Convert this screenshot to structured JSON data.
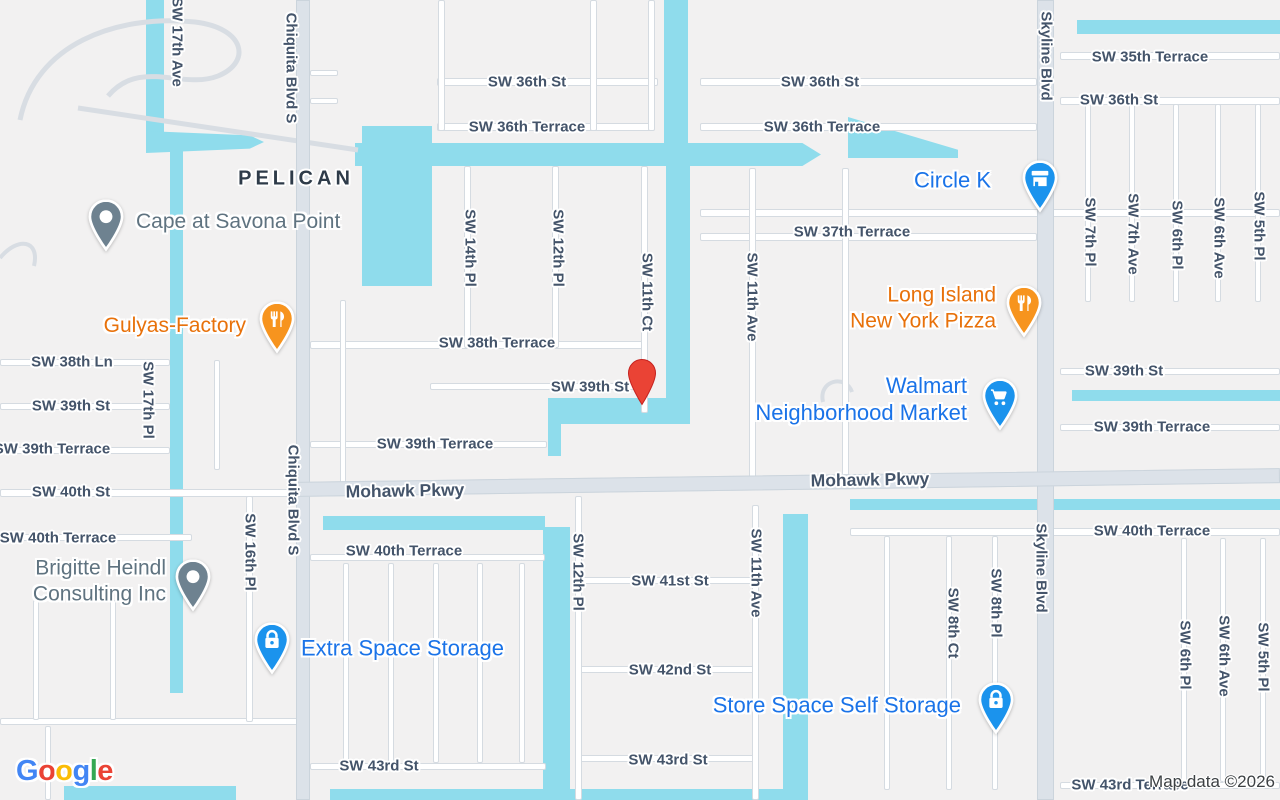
{
  "map": {
    "attribution": "Map data ©2026",
    "area_label": "PELICAN",
    "google_logo": {
      "text": "Google",
      "letters": [
        {
          "ch": "G",
          "color": "#4285F4"
        },
        {
          "ch": "o",
          "color": "#EA4335"
        },
        {
          "ch": "o",
          "color": "#FBBC05"
        },
        {
          "ch": "g",
          "color": "#4285F4"
        },
        {
          "ch": "l",
          "color": "#34A853"
        },
        {
          "ch": "e",
          "color": "#EA4335"
        }
      ]
    },
    "colors": {
      "land": "#F2F1F1",
      "water": "#8FDCEC",
      "road_minor": "#FFFFFF",
      "road_casing": "#D5DBE1",
      "road_major": "#DCE2E9",
      "street_text": "#44546A",
      "area_text": "#2E3B49",
      "poi_blue": "#1A73E8",
      "poi_orange": "#E8710A",
      "poi_gray": "#5F7380",
      "pin_blue": "#1B93ED",
      "pin_orange": "#F7941E",
      "pin_gray": "#6E8290",
      "marker_red": "#EA4335",
      "attribution_text": "#3C4043"
    },
    "marker": {
      "x": 642,
      "y": 404,
      "place_hint": "SW 39th St"
    },
    "street_labels": [
      {
        "text": "SW 36th St",
        "x": 527,
        "y": 82
      },
      {
        "text": "SW 36th Terrace",
        "x": 527,
        "y": 127
      },
      {
        "text": "SW 36th St",
        "x": 820,
        "y": 82
      },
      {
        "text": "SW 36th Terrace",
        "x": 822,
        "y": 127
      },
      {
        "text": "SW 35th Terrace",
        "x": 1150,
        "y": 57
      },
      {
        "text": "SW 36th St",
        "x": 1119,
        "y": 100
      },
      {
        "text": "SW 37th Terrace",
        "x": 852,
        "y": 232
      },
      {
        "text": "SW 38th Terrace",
        "x": 497,
        "y": 343
      },
      {
        "text": "SW 39th St",
        "x": 590,
        "y": 387
      },
      {
        "text": "SW 38th Ln",
        "x": 72,
        "y": 362
      },
      {
        "text": "SW 39th St",
        "x": 71,
        "y": 406
      },
      {
        "text": "SW 39th Terrace",
        "x": 52,
        "y": 449
      },
      {
        "text": "SW 40th St",
        "x": 71,
        "y": 492
      },
      {
        "text": "SW 40th Terrace",
        "x": 58,
        "y": 538
      },
      {
        "text": "SW 39th Terrace",
        "x": 435,
        "y": 444
      },
      {
        "text": "SW 40th Terrace",
        "x": 404,
        "y": 551
      },
      {
        "text": "SW 41st St",
        "x": 670,
        "y": 581
      },
      {
        "text": "SW 42nd St",
        "x": 670,
        "y": 670
      },
      {
        "text": "SW 43rd St",
        "x": 668,
        "y": 760
      },
      {
        "text": "SW 43rd St",
        "x": 379,
        "y": 766
      },
      {
        "text": "SW 39th St",
        "x": 1124,
        "y": 371
      },
      {
        "text": "SW 39th Terrace",
        "x": 1152,
        "y": 427
      },
      {
        "text": "SW 40th Terrace",
        "x": 1152,
        "y": 531
      },
      {
        "text": "SW 43rd Terrace",
        "x": 1130,
        "y": 785
      },
      {
        "text": "Mohawk Pkwy",
        "x": 405,
        "y": 491,
        "major": true,
        "rot": -1
      },
      {
        "text": "Mohawk Pkwy",
        "x": 870,
        "y": 480,
        "major": true,
        "rot": -1
      },
      {
        "text": "PELICAN",
        "x": 296,
        "y": 179,
        "area": true
      },
      {
        "text": "SW 17th Ave",
        "x": 177,
        "y": 42,
        "v": true
      },
      {
        "text": "Chiquita Blvd S",
        "x": 291,
        "y": 68,
        "v": true
      },
      {
        "text": "Chiquita Blvd S",
        "x": 293,
        "y": 500,
        "v": true
      },
      {
        "text": "SW 17th Pl",
        "x": 148,
        "y": 400,
        "v": true
      },
      {
        "text": "SW 16th Pl",
        "x": 250,
        "y": 552,
        "v": true
      },
      {
        "text": "SW 14th Pl",
        "x": 470,
        "y": 248,
        "v": true
      },
      {
        "text": "SW 12th Pl",
        "x": 558,
        "y": 248,
        "v": true
      },
      {
        "text": "SW 11th Ct",
        "x": 647,
        "y": 292,
        "v": true
      },
      {
        "text": "SW 11th Ave",
        "x": 752,
        "y": 297,
        "v": true
      },
      {
        "text": "Skyline Blvd",
        "x": 1046,
        "y": 56,
        "v": true
      },
      {
        "text": "Skyline Blvd",
        "x": 1041,
        "y": 568,
        "v": true
      },
      {
        "text": "SW 7th Pl",
        "x": 1090,
        "y": 232,
        "v": true
      },
      {
        "text": "SW 7th Ave",
        "x": 1133,
        "y": 234,
        "v": true
      },
      {
        "text": "SW 6th Pl",
        "x": 1177,
        "y": 235,
        "v": true
      },
      {
        "text": "SW 6th Ave",
        "x": 1219,
        "y": 238,
        "v": true
      },
      {
        "text": "SW 5th Pl",
        "x": 1259,
        "y": 226,
        "v": true
      },
      {
        "text": "SW 12th Pl",
        "x": 578,
        "y": 572,
        "v": true
      },
      {
        "text": "SW 11th Ave",
        "x": 756,
        "y": 573,
        "v": true
      },
      {
        "text": "SW 8th Ct",
        "x": 953,
        "y": 623,
        "v": true
      },
      {
        "text": "SW 8th Pl",
        "x": 996,
        "y": 603,
        "v": true
      },
      {
        "text": "SW 6th Pl",
        "x": 1185,
        "y": 655,
        "v": true
      },
      {
        "text": "SW 6th Ave",
        "x": 1224,
        "y": 656,
        "v": true
      },
      {
        "text": "SW 5th Pl",
        "x": 1263,
        "y": 657,
        "v": true
      }
    ],
    "pois": [
      {
        "id": "cape-at-savona-point",
        "lines": [
          "Cape at Savona Point"
        ],
        "category": "generic",
        "icon": "dot-icon",
        "tip_x": 106,
        "tip_y": 251,
        "label_side": "right",
        "label_x": 136,
        "label_y": 222,
        "font": 21
      },
      {
        "id": "gulyas-factory",
        "lines": [
          "Gulyas-Factory"
        ],
        "category": "restaurant",
        "icon": "restaurant-icon",
        "tip_x": 277,
        "tip_y": 353,
        "label_side": "left",
        "label_x": 246,
        "label_y": 326,
        "font": 21
      },
      {
        "id": "circle-k",
        "lines": [
          "Circle K"
        ],
        "category": "convenience-store",
        "icon": "store-icon",
        "tip_x": 1040,
        "tip_y": 212,
        "label_side": "left",
        "label_x": 991,
        "label_y": 181,
        "font": 22
      },
      {
        "id": "long-island-new-york-pizza",
        "lines": [
          "Long Island",
          "New York Pizza"
        ],
        "category": "restaurant",
        "icon": "restaurant-icon",
        "tip_x": 1024,
        "tip_y": 337,
        "label_side": "left",
        "label_x": 996,
        "label_y": 308,
        "font": 21
      },
      {
        "id": "walmart-neighborhood-market",
        "lines": [
          "Walmart",
          "Neighborhood Market"
        ],
        "category": "shopping",
        "icon": "cart-icon",
        "tip_x": 1000,
        "tip_y": 430,
        "label_side": "left",
        "label_x": 967,
        "label_y": 400,
        "font": 22
      },
      {
        "id": "extra-space-storage",
        "lines": [
          "Extra Space Storage"
        ],
        "category": "storage",
        "icon": "lock-icon",
        "tip_x": 272,
        "tip_y": 674,
        "label_side": "right",
        "label_x": 301,
        "label_y": 649,
        "font": 22
      },
      {
        "id": "store-space-self-storage",
        "lines": [
          "Store Space Self Storage"
        ],
        "category": "storage",
        "icon": "lock-icon",
        "tip_x": 996,
        "tip_y": 734,
        "label_side": "left",
        "label_x": 961,
        "label_y": 706,
        "font": 22
      },
      {
        "id": "brigitte-heindl-consulting-inc",
        "lines": [
          "Brigitte Heindl",
          "Consulting Inc"
        ],
        "category": "generic",
        "icon": "dot-icon",
        "tip_x": 193,
        "tip_y": 611,
        "label_side": "left",
        "label_x": 166,
        "label_y": 581,
        "font": 21
      }
    ]
  }
}
